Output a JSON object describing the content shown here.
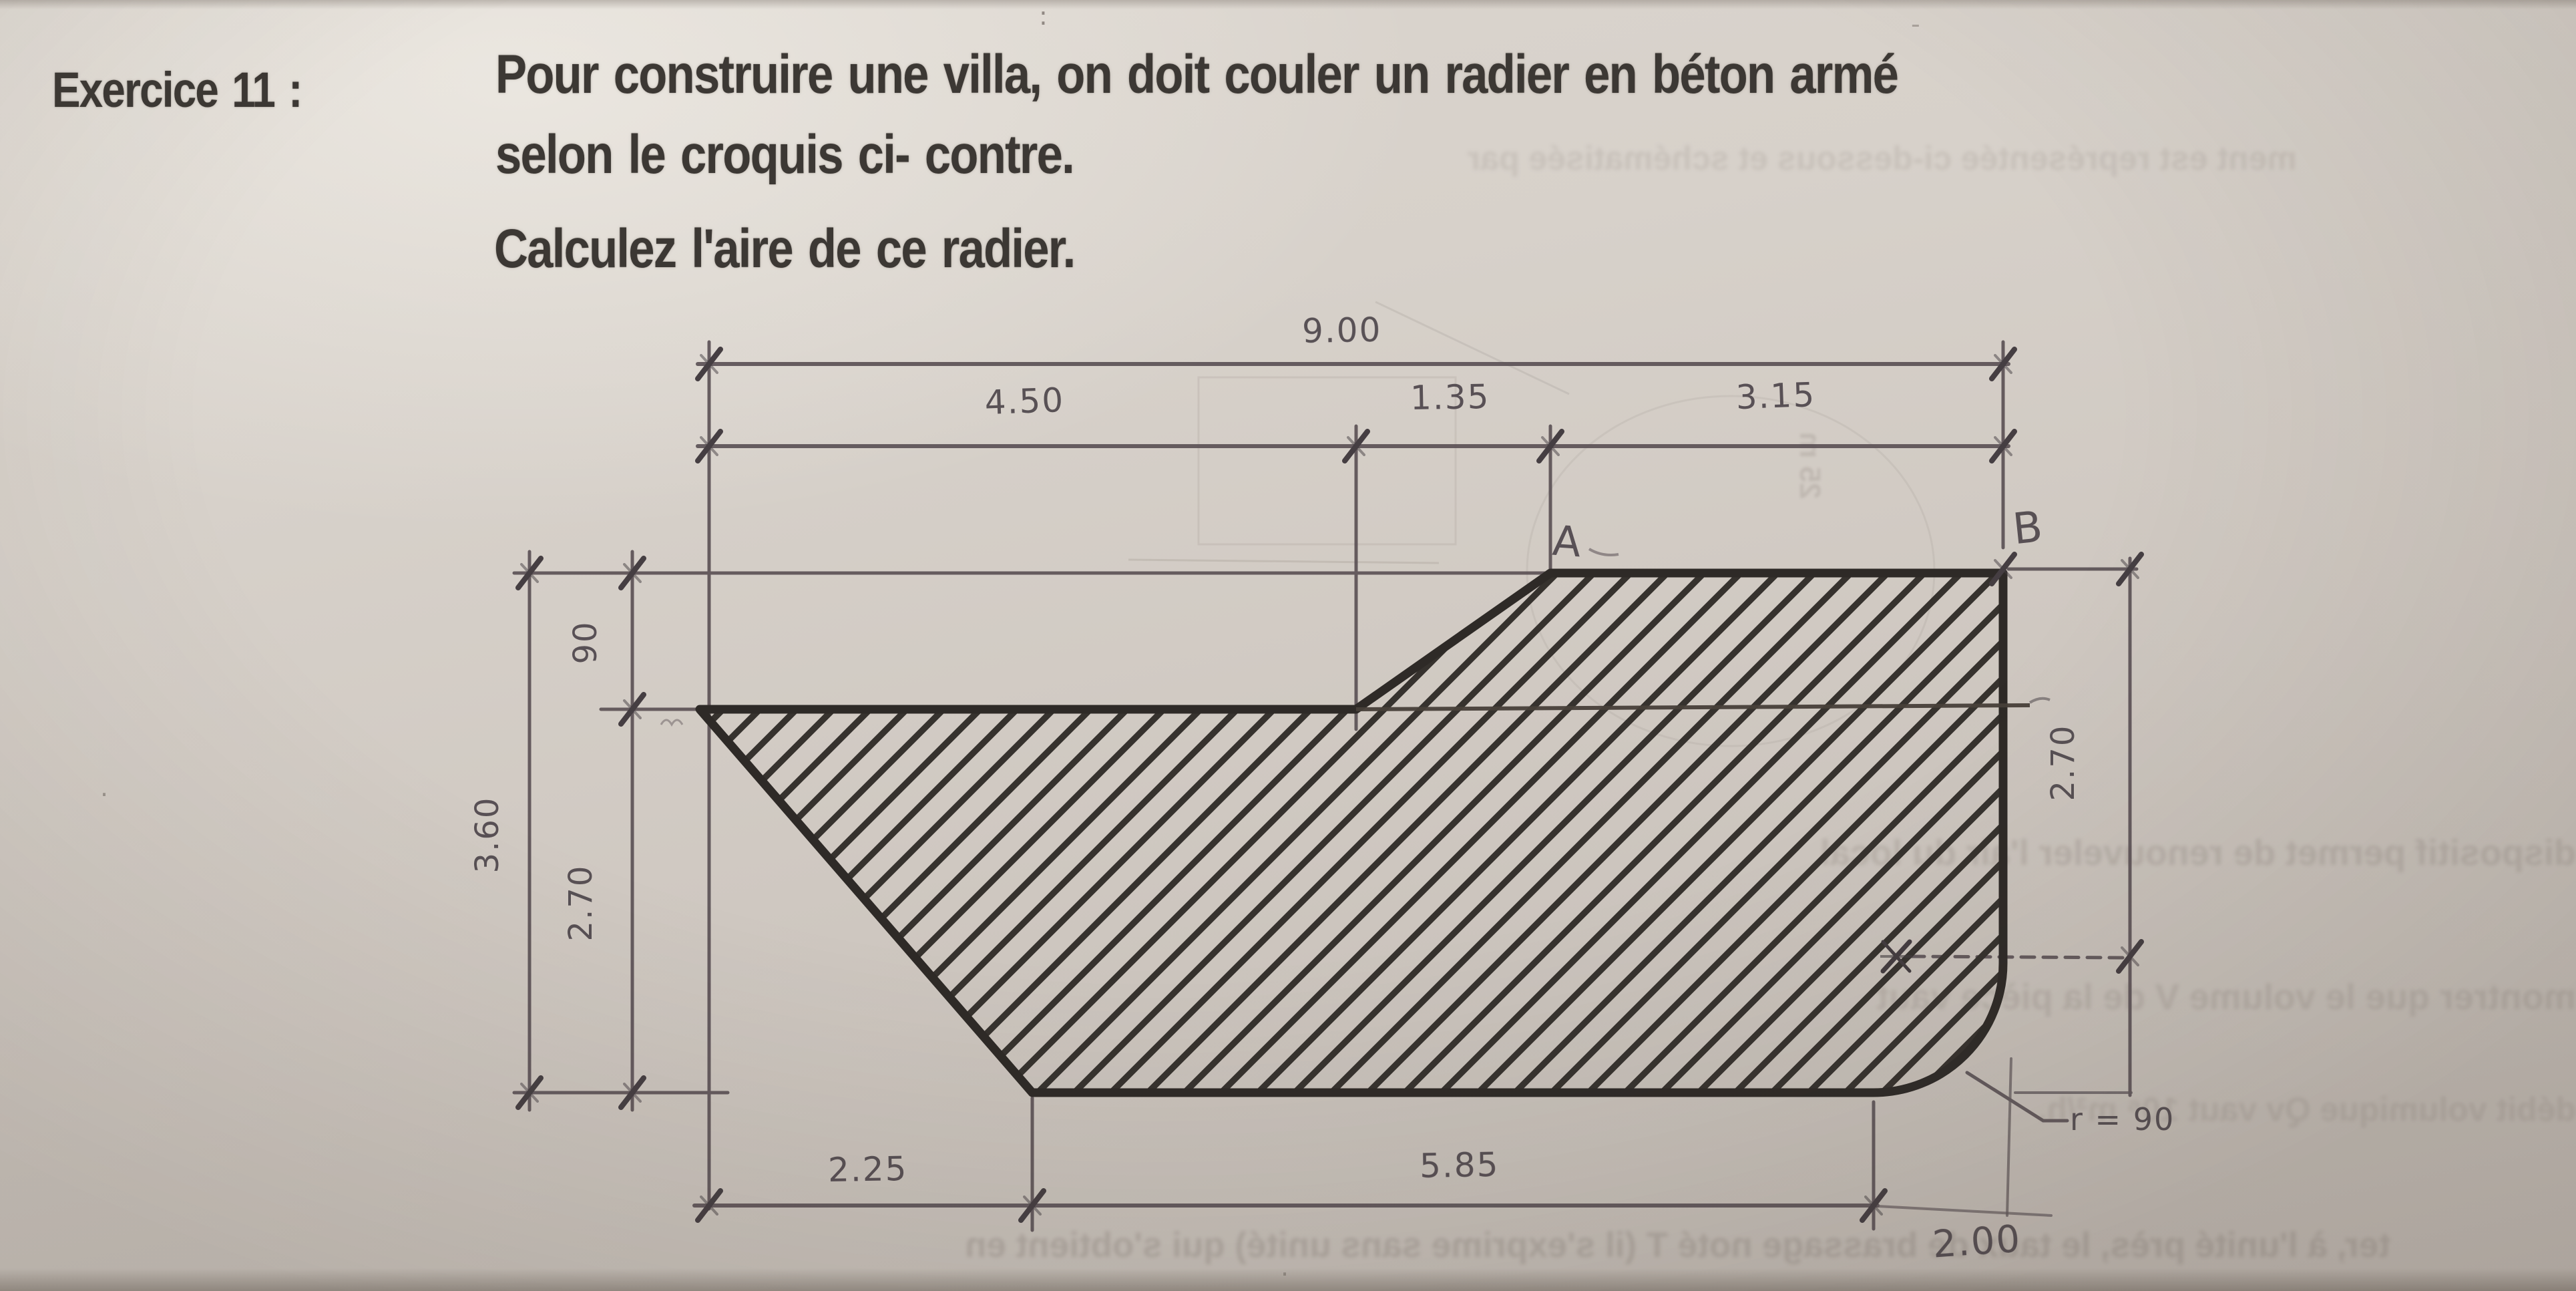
{
  "exercise": {
    "label": "Exercice 11 :",
    "line1": "Pour construire une villa, on doit couler un radier en béton armé",
    "line2": "selon le croquis ci- contre.",
    "question": "Calculez l'aire de ce radier."
  },
  "figure": {
    "total_width": "9.00",
    "seg_450": "4.50",
    "seg_135": "1.35",
    "seg_315": "3.15",
    "left_total": "3.60",
    "left_upper": "90",
    "left_lower": "2.70",
    "right_height": "2.70",
    "bottom_left": "2.25",
    "bottom_mid": "5.85",
    "bottom_right": "2.00",
    "radius": "r = 90",
    "point_a": "A",
    "point_b": "B"
  },
  "ghost": {
    "line1": "ment est représentée ci-dessous et schématisée par",
    "line2": "dispositif permet de renouveler l'air du local",
    "line3": "montrer que le volume V de la pièce vaut",
    "line4": "débit volumique Qv vaut 10⁶ m³/h.",
    "line5": "ter, à l'unité près, le taux de brassage noté T (il s'exprime sans unité) qui s'obtient en",
    "vertical_note": "25 m"
  },
  "colors": {
    "paper": "#d5cfc8",
    "ink": "#3c3834",
    "outline": "#2e2a27",
    "pencil": "#4e464b",
    "ghost": "#8f867f"
  }
}
